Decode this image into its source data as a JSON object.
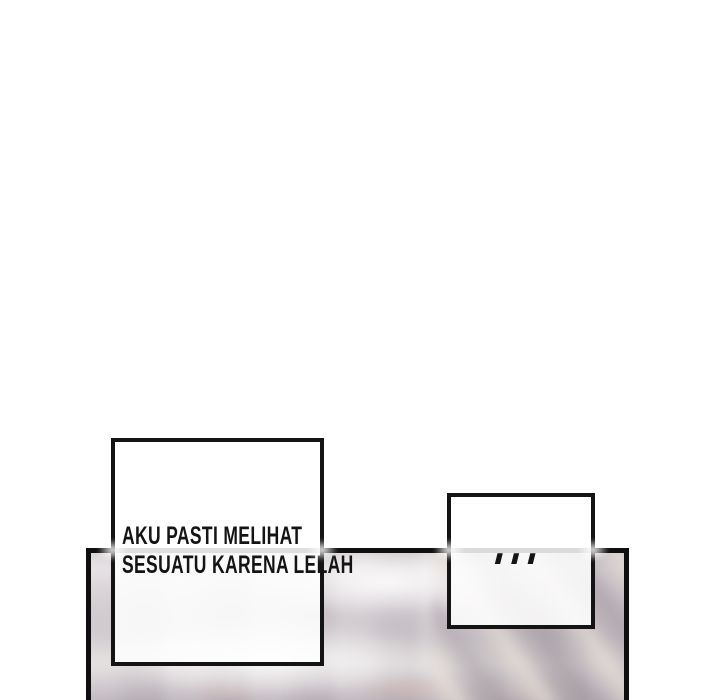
{
  "colors": {
    "page_bg": "#ffffff",
    "ink": "#141414",
    "panel_border": "#0f0f0f",
    "panel_base": "#cfc8ce",
    "panel_light_band": "#e6e2e4",
    "panel_dark_bottom": "#b2aab2",
    "panel_streak_light": "#e9e1d8",
    "panel_streak_dark": "#a49aa2",
    "panel_smudge": "#d8b7ae"
  },
  "dialogue": {
    "speech_box": {
      "lines": [
        "AKU PASTI MELIHAT",
        "SESUATU KARENA LELAH"
      ]
    },
    "ellipsis_box": {
      "text": "..."
    }
  }
}
